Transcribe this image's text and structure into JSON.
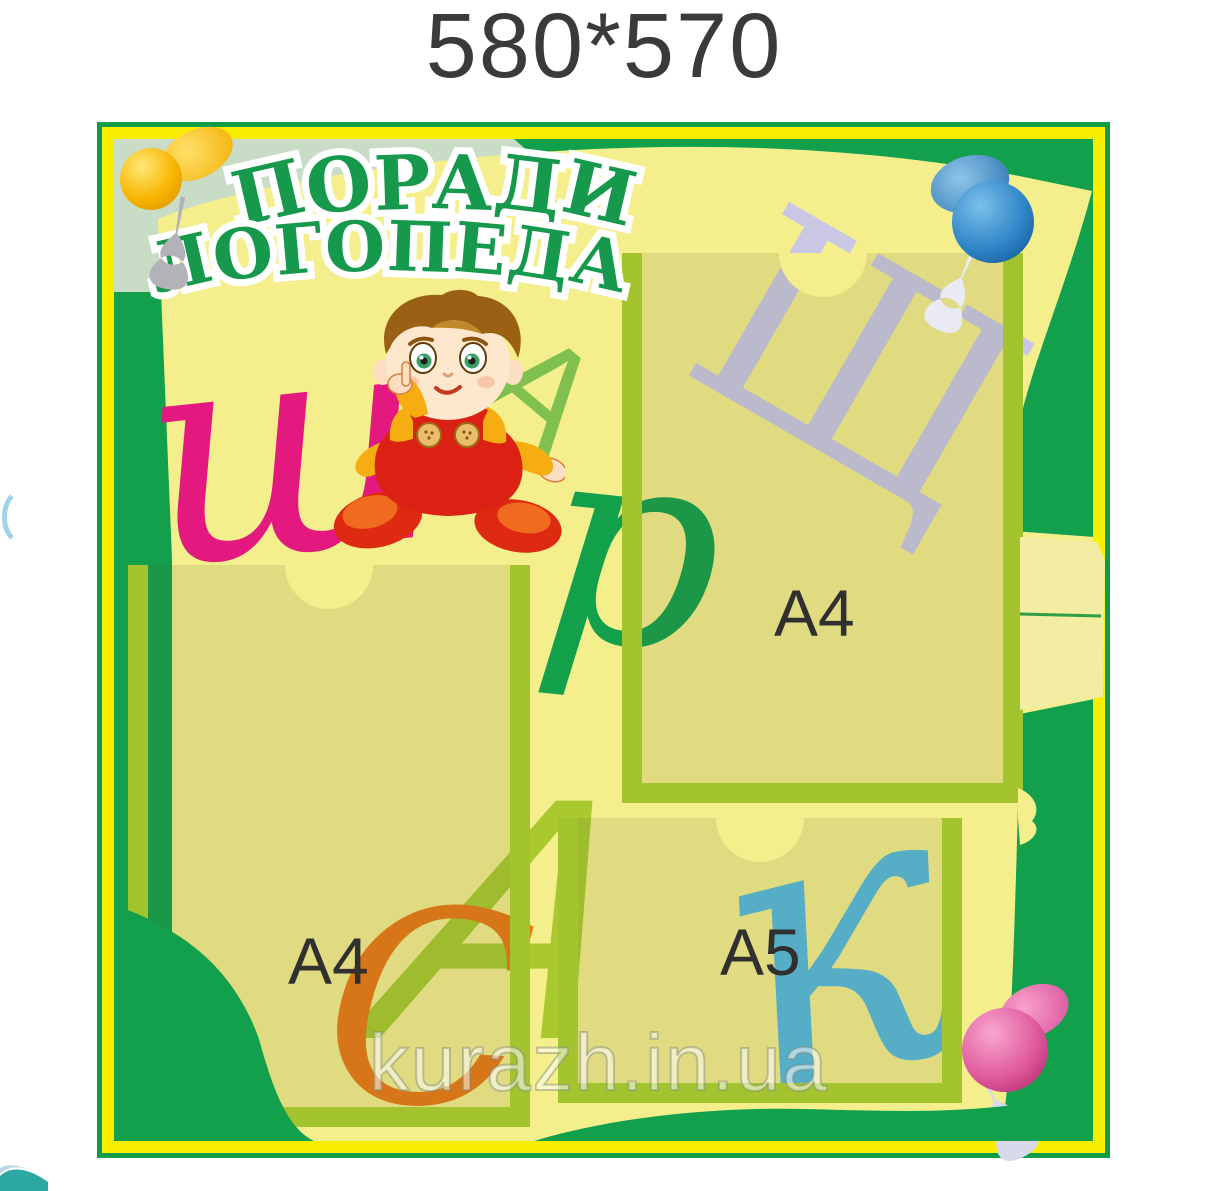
{
  "size_label": "580*570",
  "board": {
    "title": {
      "line1": "ПОРАДИ",
      "line2": "ЛОГОПЕДА"
    },
    "pockets": [
      {
        "name": "left-a4-pocket",
        "label": "A4"
      },
      {
        "name": "right-a4-pocket",
        "label": "A4"
      },
      {
        "name": "a5-pocket",
        "label": "A5"
      }
    ],
    "decor_letters": [
      {
        "char": "ш",
        "color": "#e3197f"
      },
      {
        "char": "А",
        "color": "#7fc04e"
      },
      {
        "char": "Щ",
        "color": "#c9c7e4"
      },
      {
        "char": "р",
        "color": "#12a04b"
      },
      {
        "char": "А",
        "color": "#a9c92f"
      },
      {
        "char": "С",
        "color": "#e87a15"
      },
      {
        "char": "к",
        "color": "#55badd"
      }
    ],
    "pins": [
      {
        "name": "yellow-pushpin",
        "color": "#f7b500"
      },
      {
        "name": "blue-pushpin",
        "color": "#2f86c8"
      },
      {
        "name": "pink-pushpin",
        "color": "#e05a9e"
      },
      {
        "name": "gray-tack",
        "color": "#b2b2b8"
      },
      {
        "name": "white-tack",
        "color": "#e9eaf4"
      },
      {
        "name": "lavender-tack",
        "color": "#d8daec"
      }
    ],
    "colors": {
      "frame_green": "#0e9c49",
      "frame_yellow": "#f8ee00",
      "board_green": "#12a04d",
      "paper_yellow": "#f4ee8d",
      "pocket_border": "#a3c32f",
      "mint_band": "#c8dcc6",
      "title_green": "#17994d"
    }
  },
  "watermark": "kurazh.in.ua"
}
